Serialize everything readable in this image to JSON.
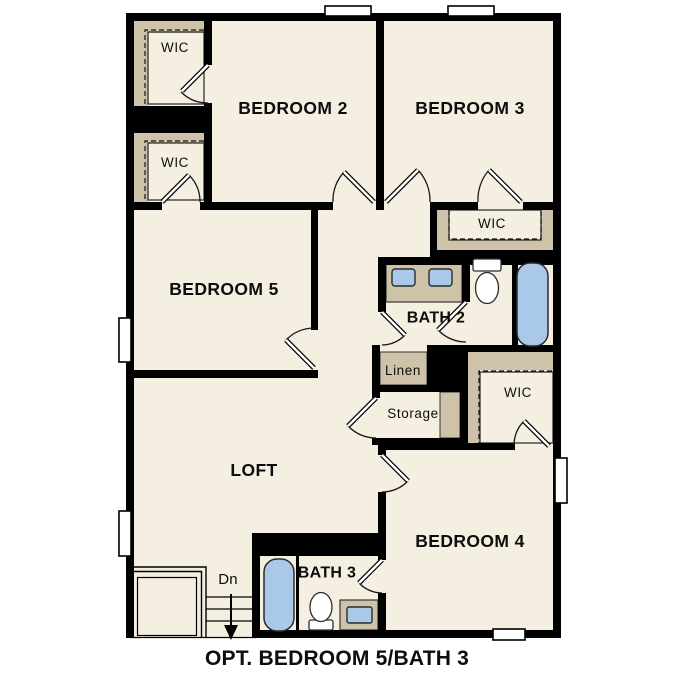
{
  "floorplan": {
    "caption": "OPT. BEDROOM 5/BATH 3",
    "rooms": {
      "bedroom2": {
        "label": "BEDROOM 2"
      },
      "bedroom3": {
        "label": "BEDROOM 3"
      },
      "bedroom4": {
        "label": "BEDROOM 4"
      },
      "bedroom5": {
        "label": "BEDROOM 5"
      },
      "loft": {
        "label": "LOFT"
      },
      "bath2": {
        "label": "BATH 2"
      },
      "bath3": {
        "label": "BATH 3"
      }
    },
    "closets": {
      "wic_bedroom2": {
        "label": "WIC"
      },
      "wic_bedroom5": {
        "label": "WIC"
      },
      "wic_bedroom3": {
        "label": "WIC"
      },
      "wic_bedroom4": {
        "label": "WIC"
      },
      "linen": {
        "label": "Linen"
      },
      "storage": {
        "label": "Storage"
      }
    },
    "stairs": {
      "direction_label": "Dn"
    },
    "fixtures": [
      "bath2-double-vanity-sinks",
      "bath2-toilet",
      "bath2-bathtub",
      "bath3-bathtub",
      "bath3-toilet",
      "bath3-vanity-sink"
    ],
    "colors": {
      "background": "#ffffff",
      "floor": "#f5efe2",
      "wall": "#000000",
      "shelving": "#cec2a9",
      "fixture_fill": "#aac9e8",
      "text": "#0d0d0d"
    }
  }
}
